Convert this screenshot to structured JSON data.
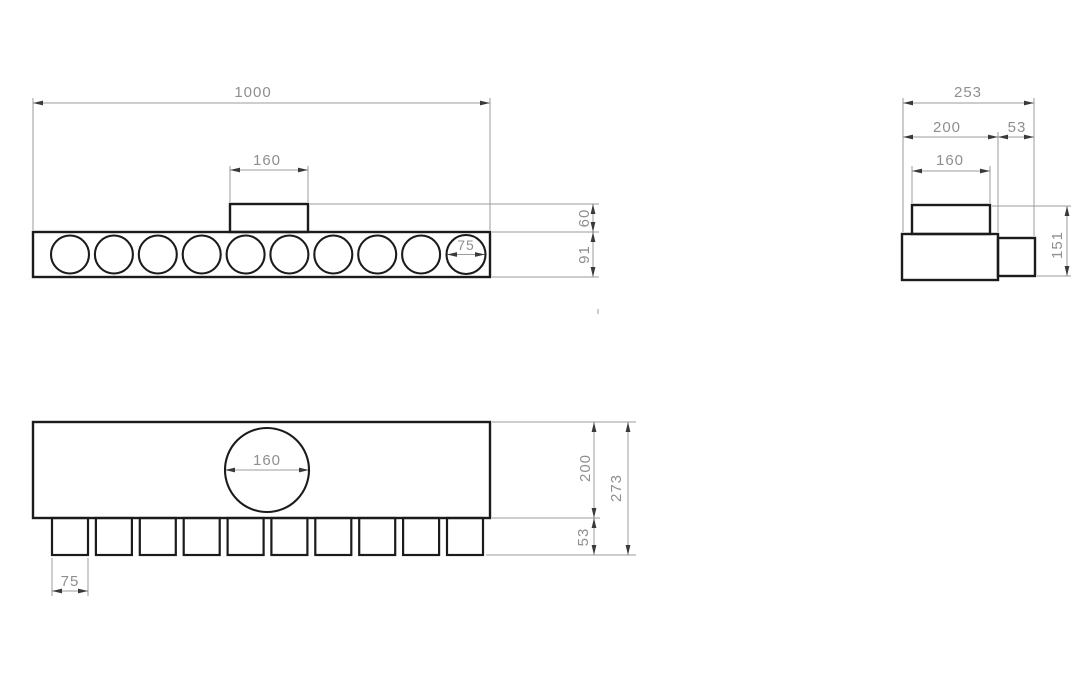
{
  "canvas": {
    "width": 1090,
    "height": 696,
    "background": "#ffffff"
  },
  "style": {
    "object_stroke": "#1b1b1b",
    "object_width": 2.4,
    "circle_width": 2.1,
    "thin_stroke": "#9b9b9b",
    "thin_width": 1,
    "arrow_fill": "#3a3a3a",
    "arrow_len": 10,
    "arrow_halfwidth": 2.4,
    "text_color": "#8f8f8f",
    "font_size": 15
  },
  "views": [
    {
      "id": "front-view",
      "outlines": [
        {
          "kind": "rect",
          "name": "front-body-outline",
          "x": 33,
          "y": 232,
          "w": 457,
          "h": 45
        },
        {
          "kind": "rect",
          "name": "front-inlet-tab-outline",
          "x": 230,
          "y": 204,
          "w": 78,
          "h": 28
        },
        {
          "kind": "circle",
          "name": "front-port-1",
          "cx": 70,
          "cy": 254.5,
          "r": 19
        },
        {
          "kind": "circle",
          "name": "front-port-2",
          "cx": 113.9,
          "cy": 254.5,
          "r": 19
        },
        {
          "kind": "circle",
          "name": "front-port-3",
          "cx": 157.8,
          "cy": 254.5,
          "r": 19
        },
        {
          "kind": "circle",
          "name": "front-port-4",
          "cx": 201.7,
          "cy": 254.5,
          "r": 19
        },
        {
          "kind": "circle",
          "name": "front-port-5",
          "cx": 245.6,
          "cy": 254.5,
          "r": 19
        },
        {
          "kind": "circle",
          "name": "front-port-6",
          "cx": 289.4,
          "cy": 254.5,
          "r": 19
        },
        {
          "kind": "circle",
          "name": "front-port-7",
          "cx": 333.3,
          "cy": 254.5,
          "r": 19
        },
        {
          "kind": "circle",
          "name": "front-port-8",
          "cx": 377.2,
          "cy": 254.5,
          "r": 19
        },
        {
          "kind": "circle",
          "name": "front-port-9",
          "cx": 421.1,
          "cy": 254.5,
          "r": 19
        },
        {
          "kind": "circle",
          "name": "front-port-10",
          "cx": 466,
          "cy": 254.5,
          "r": 19.5
        }
      ],
      "thin_lines": [
        {
          "name": "ext-1000-left",
          "x1": 33,
          "y1": 98,
          "x2": 33,
          "y2": 230
        },
        {
          "name": "ext-1000-right",
          "x1": 490,
          "y1": 98,
          "x2": 490,
          "y2": 230
        },
        {
          "name": "dimline-1000",
          "x1": 33,
          "y1": 103,
          "x2": 490,
          "y2": 103
        },
        {
          "name": "ext-160-left",
          "x1": 230,
          "y1": 166,
          "x2": 230,
          "y2": 202
        },
        {
          "name": "ext-160-right",
          "x1": 308,
          "y1": 166,
          "x2": 308,
          "y2": 202
        },
        {
          "name": "dimline-160",
          "x1": 230,
          "y1": 170,
          "x2": 308,
          "y2": 170
        },
        {
          "name": "dimline-75-diameter",
          "x1": 447,
          "y1": 254.5,
          "x2": 485,
          "y2": 254.5
        },
        {
          "name": "ext-tab-top",
          "x1": 310,
          "y1": 204,
          "x2": 599,
          "y2": 204
        },
        {
          "name": "ext-body-top",
          "x1": 492,
          "y1": 232,
          "x2": 599,
          "y2": 232
        },
        {
          "name": "ext-body-bottom",
          "x1": 492,
          "y1": 277,
          "x2": 599,
          "y2": 277
        },
        {
          "name": "dimline-60-91",
          "x1": 593,
          "y1": 204,
          "x2": 593,
          "y2": 277
        }
      ],
      "arrows": [
        {
          "x": 33,
          "y": 103,
          "dir": "left"
        },
        {
          "x": 490,
          "y": 103,
          "dir": "right"
        },
        {
          "x": 230,
          "y": 170,
          "dir": "left"
        },
        {
          "x": 308,
          "y": 170,
          "dir": "right"
        },
        {
          "x": 447,
          "y": 254.5,
          "dir": "left"
        },
        {
          "x": 485,
          "y": 254.5,
          "dir": "right"
        },
        {
          "x": 593,
          "y": 204,
          "dir": "up"
        },
        {
          "x": 593,
          "y": 232,
          "dir": "down"
        },
        {
          "x": 593,
          "y": 232,
          "dir": "up"
        },
        {
          "x": 593,
          "y": 277,
          "dir": "down"
        }
      ],
      "labels": [
        {
          "name": "dim-label-1000",
          "text": "1000",
          "x": 253,
          "y": 97
        },
        {
          "name": "dim-label-160",
          "text": "160",
          "x": 267,
          "y": 165
        },
        {
          "name": "dim-label-75",
          "text": "75",
          "x": 466,
          "y": 250,
          "size": 14
        },
        {
          "name": "dim-label-60",
          "text": "60",
          "x": 589,
          "y": 218,
          "rotate": -90
        },
        {
          "name": "dim-label-91",
          "text": "91",
          "x": 589,
          "y": 254.5,
          "rotate": -90
        }
      ]
    },
    {
      "id": "side-view",
      "outlines": [
        {
          "kind": "rect",
          "name": "side-body-outline",
          "x": 902,
          "y": 234,
          "w": 96,
          "h": 46
        },
        {
          "kind": "rect",
          "name": "side-inlet-tab-outline",
          "x": 912,
          "y": 205,
          "w": 78,
          "h": 29
        },
        {
          "kind": "rect",
          "name": "side-nozzle-outline",
          "x": 998,
          "y": 238,
          "w": 37,
          "h": 38
        }
      ],
      "thin_lines": [
        {
          "name": "ext-253-left",
          "x1": 903,
          "y1": 98,
          "x2": 903,
          "y2": 232
        },
        {
          "name": "ext-253-right",
          "x1": 1034,
          "y1": 98,
          "x2": 1034,
          "y2": 236
        },
        {
          "name": "dimline-253",
          "x1": 903,
          "y1": 103,
          "x2": 1034,
          "y2": 103
        },
        {
          "name": "ext-200-53-mid",
          "x1": 998,
          "y1": 132,
          "x2": 998,
          "y2": 232
        },
        {
          "name": "dimline-200-53",
          "x1": 903,
          "y1": 137,
          "x2": 1034,
          "y2": 137
        },
        {
          "name": "ext-160-left",
          "x1": 912,
          "y1": 166,
          "x2": 912,
          "y2": 203
        },
        {
          "name": "ext-160-right",
          "x1": 990,
          "y1": 166,
          "x2": 990,
          "y2": 203
        },
        {
          "name": "dimline-160",
          "x1": 912,
          "y1": 171,
          "x2": 990,
          "y2": 171
        },
        {
          "name": "ext-151-top",
          "x1": 992,
          "y1": 206,
          "x2": 1071,
          "y2": 206
        },
        {
          "name": "ext-151-bottom",
          "x1": 1037,
          "y1": 276,
          "x2": 1071,
          "y2": 276
        },
        {
          "name": "dimline-151",
          "x1": 1067,
          "y1": 206,
          "x2": 1067,
          "y2": 276
        }
      ],
      "arrows": [
        {
          "x": 903,
          "y": 103,
          "dir": "left"
        },
        {
          "x": 1034,
          "y": 103,
          "dir": "right"
        },
        {
          "x": 903,
          "y": 137,
          "dir": "left"
        },
        {
          "x": 998,
          "y": 137,
          "dir": "right"
        },
        {
          "x": 998,
          "y": 137,
          "dir": "left"
        },
        {
          "x": 1034,
          "y": 137,
          "dir": "right"
        },
        {
          "x": 912,
          "y": 171,
          "dir": "left"
        },
        {
          "x": 990,
          "y": 171,
          "dir": "right"
        },
        {
          "x": 1067,
          "y": 206,
          "dir": "up"
        },
        {
          "x": 1067,
          "y": 276,
          "dir": "down"
        }
      ],
      "labels": [
        {
          "name": "dim-label-253",
          "text": "253",
          "x": 968,
          "y": 97
        },
        {
          "name": "dim-label-200",
          "text": "200",
          "x": 947,
          "y": 132
        },
        {
          "name": "dim-label-53",
          "text": "53",
          "x": 1017,
          "y": 132
        },
        {
          "name": "dim-label-160",
          "text": "160",
          "x": 950,
          "y": 165
        },
        {
          "name": "dim-label-151",
          "text": "151",
          "x": 1062,
          "y": 245,
          "rotate": -90
        }
      ]
    },
    {
      "id": "plan-view",
      "outlines": [
        {
          "kind": "rect",
          "name": "plan-body-outline",
          "x": 33,
          "y": 422,
          "w": 457,
          "h": 96
        },
        {
          "kind": "circle",
          "name": "plan-inlet-circle",
          "cx": 267,
          "cy": 470,
          "r": 42
        },
        {
          "kind": "rect",
          "name": "plan-stub-1",
          "x": 52,
          "y": 518,
          "w": 36,
          "h": 37,
          "w2": 2.2
        },
        {
          "kind": "rect",
          "name": "plan-stub-2",
          "x": 95.9,
          "y": 518,
          "w": 36,
          "h": 37,
          "w2": 2.2
        },
        {
          "kind": "rect",
          "name": "plan-stub-3",
          "x": 139.8,
          "y": 518,
          "w": 36,
          "h": 37,
          "w2": 2.2
        },
        {
          "kind": "rect",
          "name": "plan-stub-4",
          "x": 183.7,
          "y": 518,
          "w": 36,
          "h": 37,
          "w2": 2.2
        },
        {
          "kind": "rect",
          "name": "plan-stub-5",
          "x": 227.6,
          "y": 518,
          "w": 36,
          "h": 37,
          "w2": 2.2
        },
        {
          "kind": "rect",
          "name": "plan-stub-6",
          "x": 271.4,
          "y": 518,
          "w": 36,
          "h": 37,
          "w2": 2.2
        },
        {
          "kind": "rect",
          "name": "plan-stub-7",
          "x": 315.3,
          "y": 518,
          "w": 36,
          "h": 37,
          "w2": 2.2
        },
        {
          "kind": "rect",
          "name": "plan-stub-8",
          "x": 359.2,
          "y": 518,
          "w": 36,
          "h": 37,
          "w2": 2.2
        },
        {
          "kind": "rect",
          "name": "plan-stub-9",
          "x": 403.1,
          "y": 518,
          "w": 36,
          "h": 37,
          "w2": 2.2
        },
        {
          "kind": "rect",
          "name": "plan-stub-10",
          "x": 447,
          "y": 518,
          "w": 36,
          "h": 37,
          "w2": 2.2
        }
      ],
      "thin_lines": [
        {
          "name": "dimline-160-circle",
          "x1": 225,
          "y1": 470,
          "x2": 309,
          "y2": 470
        },
        {
          "name": "ext-75-left",
          "x1": 52,
          "y1": 558,
          "x2": 52,
          "y2": 596
        },
        {
          "name": "ext-75-right",
          "x1": 88,
          "y1": 558,
          "x2": 88,
          "y2": 596
        },
        {
          "name": "dimline-75",
          "x1": 52,
          "y1": 591,
          "x2": 88,
          "y2": 591
        },
        {
          "name": "ext-top",
          "x1": 492,
          "y1": 422,
          "x2": 636,
          "y2": 422
        },
        {
          "name": "ext-mid",
          "x1": 492,
          "y1": 518,
          "x2": 600,
          "y2": 518
        },
        {
          "name": "ext-stub-bottom",
          "x1": 486,
          "y1": 555,
          "x2": 636,
          "y2": 555
        },
        {
          "name": "dimline-200-53",
          "x1": 594,
          "y1": 422,
          "x2": 594,
          "y2": 555
        },
        {
          "name": "dimline-273",
          "x1": 628,
          "y1": 422,
          "x2": 628,
          "y2": 555
        }
      ],
      "arrows": [
        {
          "x": 225,
          "y": 470,
          "dir": "left"
        },
        {
          "x": 309,
          "y": 470,
          "dir": "right"
        },
        {
          "x": 52,
          "y": 591,
          "dir": "left"
        },
        {
          "x": 88,
          "y": 591,
          "dir": "right"
        },
        {
          "x": 594,
          "y": 422,
          "dir": "up"
        },
        {
          "x": 594,
          "y": 518,
          "dir": "down"
        },
        {
          "x": 594,
          "y": 518,
          "dir": "up"
        },
        {
          "x": 594,
          "y": 555,
          "dir": "down"
        },
        {
          "x": 628,
          "y": 422,
          "dir": "up"
        },
        {
          "x": 628,
          "y": 555,
          "dir": "down"
        }
      ],
      "labels": [
        {
          "name": "dim-label-160",
          "text": "160",
          "x": 267,
          "y": 465
        },
        {
          "name": "dim-label-75",
          "text": "75",
          "x": 70,
          "y": 586
        },
        {
          "name": "dim-label-200",
          "text": "200",
          "x": 590,
          "y": 468,
          "rotate": -90
        },
        {
          "name": "dim-label-53",
          "text": "53",
          "x": 588,
          "y": 537,
          "rotate": -90
        },
        {
          "name": "dim-label-273",
          "text": "273",
          "x": 621,
          "y": 488,
          "rotate": -90
        }
      ]
    },
    {
      "id": "artifacts",
      "outlines": [],
      "thin_lines": [
        {
          "name": "scan-speck",
          "x1": 598,
          "y1": 309,
          "x2": 598,
          "y2": 314
        }
      ],
      "arrows": [],
      "labels": []
    }
  ]
}
